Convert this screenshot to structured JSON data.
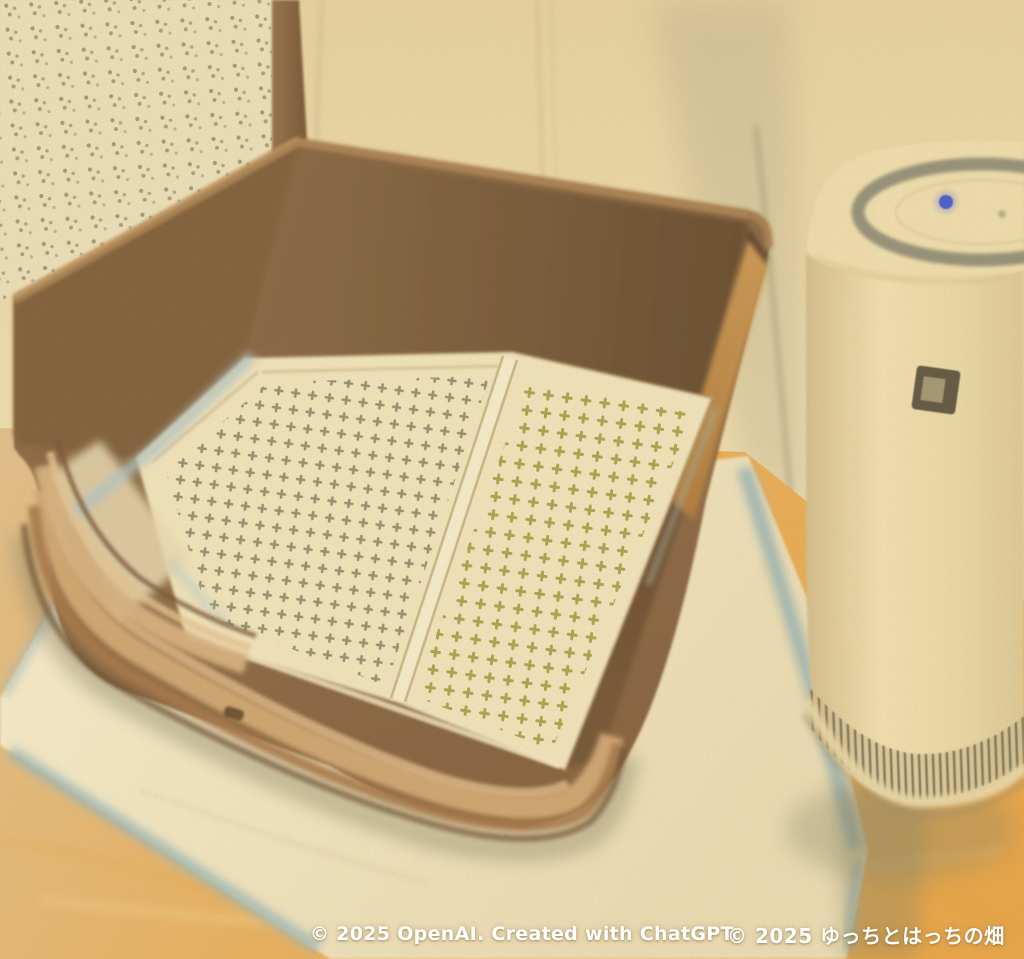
{
  "image": {
    "medium": "colored pencil illustration",
    "subject": "indoor dog toilet: brown tray with two mesh grid panels sitting on a pee pad, cane-webbing wall panel behind, cylindrical air purifier at right",
    "width": 1024,
    "height": 959
  },
  "objects": [
    "cane-webbing wall panel",
    "cream wall",
    "wood floor",
    "pee pad with pale blue edges",
    "brown pet toilet tray",
    "left mesh grid panel",
    "right mesh grid panel",
    "air purifier with power LED, control button and vent band"
  ],
  "watermark": {
    "openai": "© 2025 OpenAI. Created with ChatGPT.",
    "artist": "© 2025 ゆっちとはっちの畑",
    "color": "#ffffff"
  },
  "palette": {
    "wall": "#ecd8a8",
    "cane_panel": "#ece0b8",
    "cane_dots": "#8e8966",
    "corner_trim": "#8c6a46",
    "tray_brown": "#8f6b45",
    "tray_inner_dark": "#6c5134",
    "rim_highlight": "#d4ab76",
    "mesh_cream": "#f1e3ba",
    "mesh_dots_left": "#968f72",
    "mesh_dots_right": "#aca24c",
    "pad_cream": "#f3e7c3",
    "pad_edge_blue": "#a3bab6",
    "tray_pad_strip": "#b2c6c4",
    "floor_wood": "#e9ae55",
    "purifier_body": "#f0deae",
    "purifier_ring": "#8b8871",
    "power_led_blue": "#4a5ed0",
    "button_dark": "#675d46",
    "vent_ribs": "#7b7156",
    "shadow_olive": "#958c6d"
  }
}
